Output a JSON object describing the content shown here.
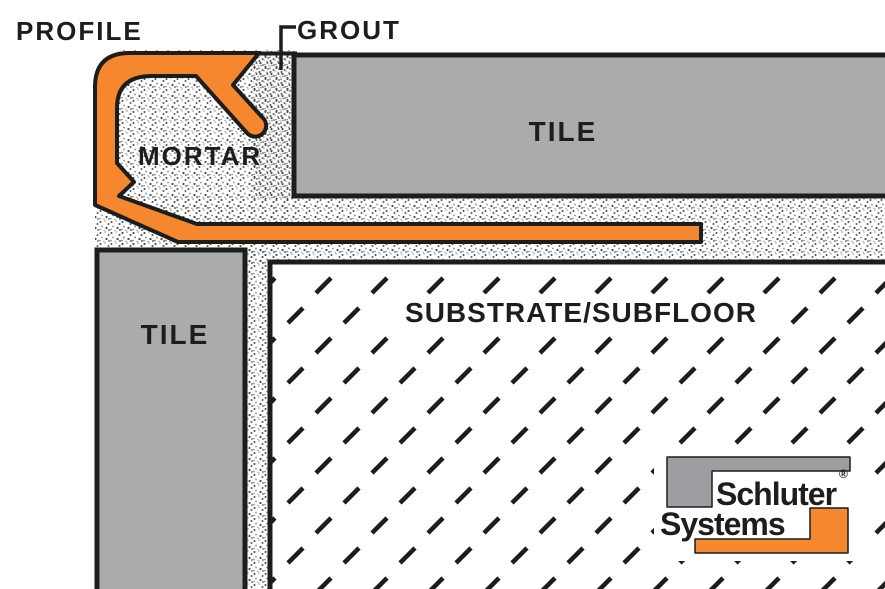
{
  "diagram": {
    "labels": {
      "profile": "PROFILE",
      "grout": "GROUT",
      "mortar": "MORTAR",
      "tile_top": "TILE",
      "tile_left": "TILE",
      "substrate": "SUBSTRATE/SUBFLOOR"
    },
    "logo": {
      "brand_line1": "Schluter",
      "registered_mark": "®",
      "brand_line2": "Systems"
    },
    "colors": {
      "profile_orange": "#f5872e",
      "tile_gray": "#a9abad",
      "logo_gray": "#9c9ea1",
      "logo_orange": "#f5872e",
      "outline_black": "#1d1d1b",
      "background": "#ffffff"
    }
  }
}
